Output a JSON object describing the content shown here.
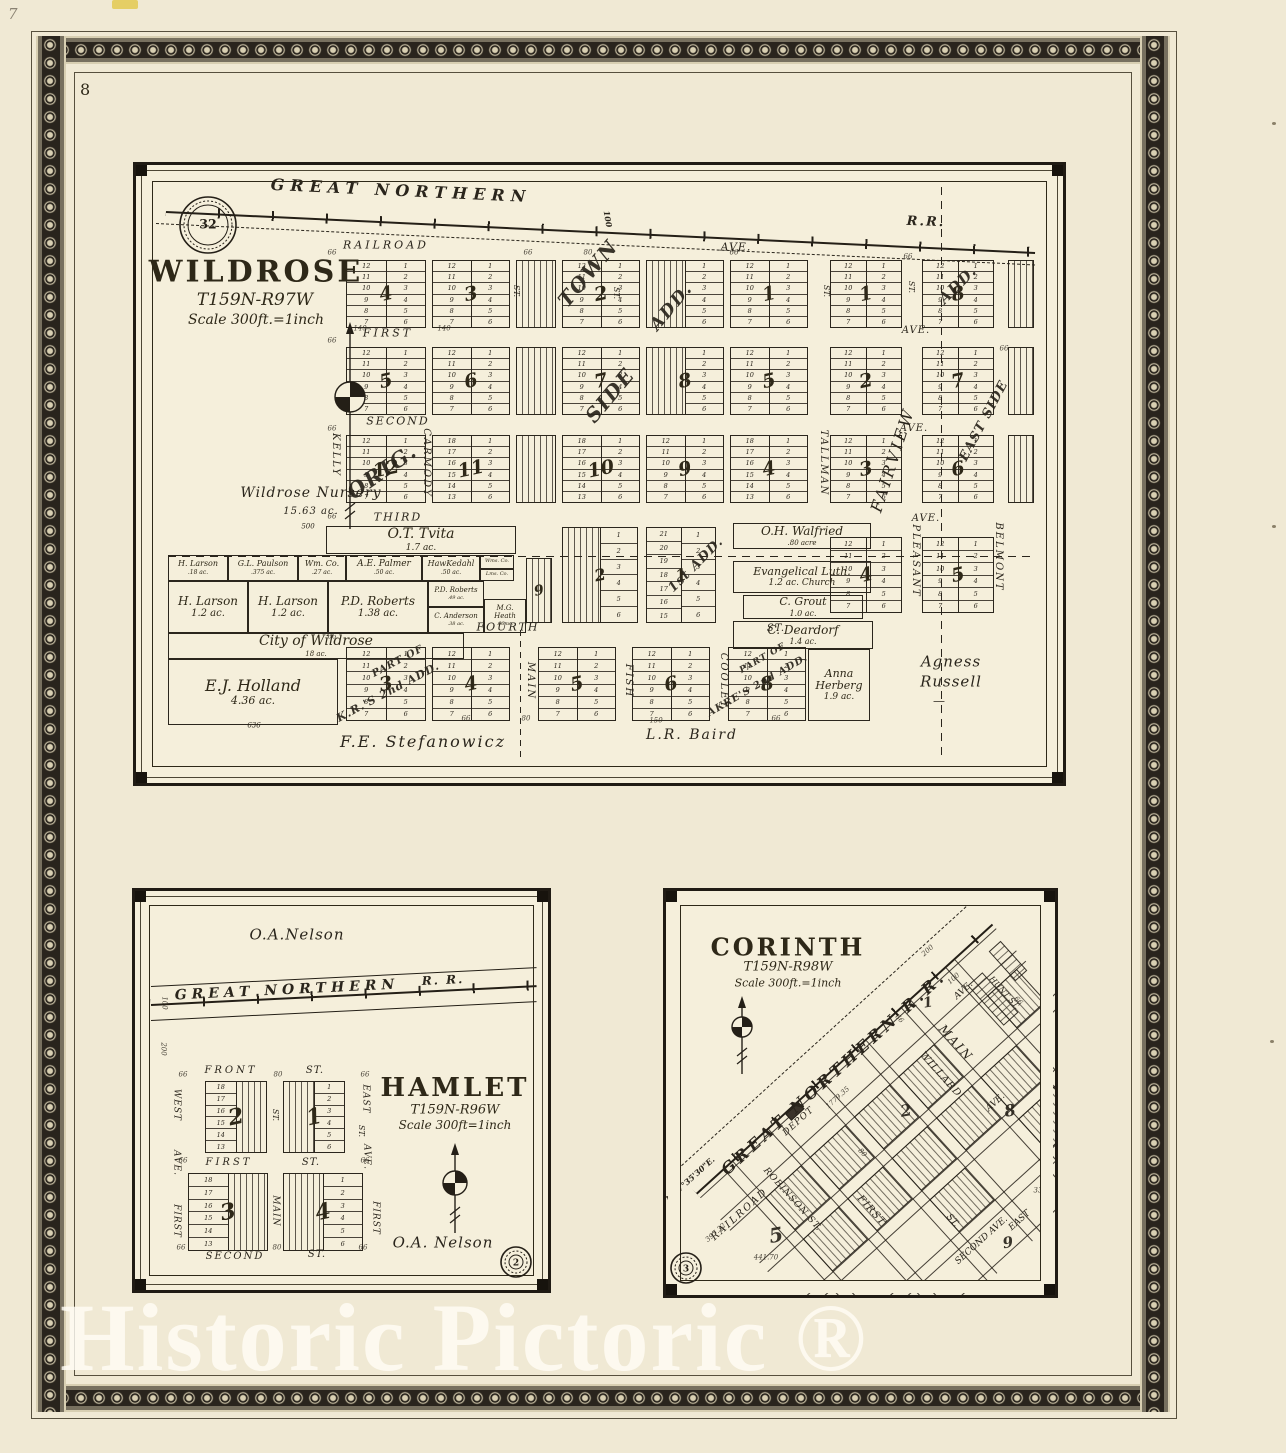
{
  "page": {
    "number": "8",
    "pencil_mark": "7",
    "watermark": "Historic Pictoric ®"
  },
  "colors": {
    "paper": "#f0e9d4",
    "panel_paper": "#f5efdb",
    "ink": "#2a251c",
    "border_band": "#29241d"
  },
  "wildrose": {
    "title": "WILDROSE",
    "township": "T159N-R97W",
    "scale": "Scale 300ft.=1inch",
    "section_stamp": "32",
    "rrlabels": [
      [
        "GREAT NORTHERN",
        265,
        26,
        2.7,
        16,
        6
      ],
      [
        "R.R.",
        790,
        57,
        2,
        13,
        2
      ],
      [
        "100",
        472,
        54,
        80,
        8,
        0
      ]
    ],
    "streets": [
      [
        "RAILROAD",
        250,
        80,
        0,
        11,
        3
      ],
      [
        "AVE.",
        600,
        82,
        0,
        11,
        1
      ],
      [
        "FIRST",
        252,
        168,
        0,
        11,
        3
      ],
      [
        "AVE.",
        780,
        166,
        0,
        10,
        1
      ],
      [
        "SECOND",
        262,
        256,
        0,
        11,
        2
      ],
      [
        "AVE.",
        778,
        264,
        0,
        10,
        1
      ],
      [
        "THIRD",
        262,
        352,
        0,
        11,
        2
      ],
      [
        "AVE.",
        790,
        354,
        0,
        10,
        1
      ],
      [
        "FOURTH",
        372,
        462,
        0,
        11,
        2
      ],
      [
        "ST.",
        640,
        464,
        0,
        10,
        1
      ],
      [
        "KELLY",
        199,
        290,
        90,
        10,
        2
      ],
      [
        "CARMODY",
        290,
        298,
        90,
        10,
        2
      ],
      [
        "MAIN",
        394,
        516,
        90,
        10,
        2
      ],
      [
        "FISH",
        492,
        516,
        90,
        10,
        2
      ],
      [
        "COOLEY",
        587,
        516,
        90,
        10,
        2
      ],
      [
        "TALLMAN",
        687,
        298,
        90,
        10,
        2
      ],
      [
        "PLEASANT",
        779,
        396,
        90,
        10,
        2
      ],
      [
        "BELMONT",
        862,
        392,
        90,
        10,
        2
      ],
      [
        "FAIRVIEW",
        757,
        295,
        -72,
        16,
        3
      ],
      [
        "ST.",
        380,
        126,
        90,
        8,
        0
      ],
      [
        "ST.",
        480,
        128,
        90,
        8,
        0
      ],
      [
        "ST.",
        690,
        126,
        90,
        8,
        0
      ],
      [
        "ST.",
        775,
        122,
        90,
        8,
        0
      ]
    ],
    "additions": [
      [
        "TOWN",
        452,
        108,
        -50,
        20,
        2
      ],
      [
        "SIDE",
        474,
        230,
        -50,
        20,
        2
      ],
      [
        "ADD.",
        536,
        142,
        -50,
        17,
        2
      ],
      [
        "ORIG.",
        246,
        306,
        -35,
        21,
        2
      ],
      [
        "EAST SIDE",
        848,
        256,
        -62,
        13,
        1
      ],
      [
        "1st ADD.",
        560,
        400,
        -45,
        13,
        1
      ],
      [
        "PART OF",
        262,
        497,
        -28,
        10,
        1
      ],
      [
        "K.R.'S 2nd ADD.",
        252,
        527,
        -28,
        11,
        1
      ],
      [
        "PART OF",
        627,
        494,
        -30,
        9,
        1
      ],
      [
        "AKRE'S 2nd ADD.",
        622,
        521,
        -30,
        10,
        1
      ],
      [
        "ADD.",
        822,
        120,
        -45,
        15,
        1
      ]
    ],
    "texts": [
      [
        "Wildrose Nursery",
        175,
        328,
        0,
        14,
        1
      ],
      [
        "15.63 ac.",
        175,
        347,
        0,
        10,
        1
      ],
      [
        "500",
        172,
        362,
        0,
        7,
        0
      ],
      [
        "F.E. Stefanowicz",
        287,
        577,
        0,
        16,
        2
      ],
      [
        "L.R. Baird",
        556,
        570,
        0,
        14,
        2
      ],
      [
        "Agness",
        815,
        497,
        0,
        15,
        1
      ],
      [
        "Russell",
        815,
        517,
        0,
        15,
        1
      ],
      [
        "—",
        803,
        536,
        0,
        12,
        0
      ],
      [
        "636",
        118,
        561,
        0,
        7,
        0
      ]
    ],
    "dims": [
      [
        "66",
        196,
        88
      ],
      [
        "66",
        392,
        88
      ],
      [
        "80",
        452,
        88
      ],
      [
        "66",
        598,
        88
      ],
      [
        "66",
        196,
        176
      ],
      [
        "66",
        196,
        264
      ],
      [
        "66",
        196,
        352
      ],
      [
        "66",
        196,
        472
      ],
      [
        "66",
        330,
        554
      ],
      [
        "80",
        390,
        554
      ],
      [
        "66",
        772,
        92
      ],
      [
        "66",
        868,
        184
      ],
      [
        "140",
        224,
        164
      ],
      [
        "140",
        308,
        164
      ],
      [
        "150",
        520,
        556
      ],
      [
        "66",
        640,
        554
      ]
    ],
    "blocks": [
      [
        210,
        95,
        80,
        68,
        "4",
        "12",
        "6"
      ],
      [
        296,
        95,
        78,
        68,
        "3",
        "12",
        "6"
      ],
      [
        380,
        95,
        40,
        68,
        "",
        "s",
        ""
      ],
      [
        426,
        95,
        78,
        68,
        "2",
        "12",
        "6"
      ],
      [
        510,
        95,
        78,
        68,
        "",
        "s",
        "6"
      ],
      [
        594,
        95,
        78,
        68,
        "1",
        "12",
        "6"
      ],
      [
        694,
        95,
        72,
        68,
        "1",
        "12",
        "6"
      ],
      [
        786,
        95,
        72,
        68,
        "8",
        "12",
        "6"
      ],
      [
        872,
        95,
        26,
        68,
        "",
        "s",
        ""
      ],
      [
        210,
        182,
        80,
        68,
        "5",
        "12",
        "6"
      ],
      [
        296,
        182,
        78,
        68,
        "6",
        "12",
        "6"
      ],
      [
        380,
        182,
        40,
        68,
        "",
        "s",
        ""
      ],
      [
        426,
        182,
        78,
        68,
        "7",
        "12",
        "6"
      ],
      [
        510,
        182,
        78,
        68,
        "8",
        "s",
        "6"
      ],
      [
        594,
        182,
        78,
        68,
        "5",
        "12",
        "6"
      ],
      [
        694,
        182,
        72,
        68,
        "2",
        "12",
        "6"
      ],
      [
        786,
        182,
        72,
        68,
        "7",
        "12",
        "6"
      ],
      [
        872,
        182,
        26,
        68,
        "",
        "s",
        ""
      ],
      [
        210,
        270,
        80,
        68,
        "12",
        "12",
        "6"
      ],
      [
        296,
        270,
        78,
        68,
        "11",
        "18",
        "6"
      ],
      [
        380,
        270,
        40,
        68,
        "",
        "s",
        ""
      ],
      [
        426,
        270,
        78,
        68,
        "10",
        "18",
        "6"
      ],
      [
        510,
        270,
        78,
        68,
        "9",
        "12",
        "6"
      ],
      [
        594,
        270,
        78,
        68,
        "4",
        "18",
        "6"
      ],
      [
        694,
        270,
        72,
        68,
        "3",
        "12",
        "6"
      ],
      [
        786,
        270,
        72,
        68,
        "6",
        "12",
        "6"
      ],
      [
        872,
        270,
        26,
        68,
        "",
        "s",
        ""
      ],
      [
        390,
        393,
        26,
        65,
        "9",
        "s",
        "",
        14
      ],
      [
        426,
        362,
        76,
        96,
        "2",
        "s",
        "6",
        16
      ],
      [
        510,
        362,
        70,
        96,
        "1",
        "21",
        "6",
        16
      ],
      [
        694,
        372,
        72,
        76,
        "4",
        "12",
        "6"
      ],
      [
        786,
        372,
        72,
        76,
        "5",
        "12",
        "6"
      ],
      [
        210,
        482,
        80,
        74,
        "3",
        "12",
        "6"
      ],
      [
        296,
        482,
        78,
        74,
        "4",
        "12",
        "6"
      ],
      [
        402,
        482,
        78,
        74,
        "5",
        "12",
        "6"
      ],
      [
        496,
        482,
        78,
        74,
        "6",
        "12",
        "6"
      ],
      [
        592,
        482,
        78,
        74,
        "8",
        "12",
        "6"
      ]
    ],
    "parcels": [
      [
        190,
        361,
        190,
        28,
        "O.T. Tvita",
        "1.7 ac.",
        14,
        9
      ],
      [
        32,
        390,
        60,
        26,
        "H. Larson",
        ".18 ac.",
        8,
        6
      ],
      [
        92,
        390,
        70,
        26,
        "G.L. Paulson",
        ".375 ac.",
        8,
        6
      ],
      [
        162,
        390,
        48,
        26,
        "Wm. Co.",
        ".27 ac.",
        8,
        6
      ],
      [
        210,
        390,
        76,
        26,
        "A.E. Palmer",
        ".50 ac.",
        9,
        6
      ],
      [
        286,
        390,
        58,
        26,
        "HawKedahl",
        ".50 ac.",
        8,
        6
      ],
      [
        344,
        390,
        34,
        14,
        "Wms. Co.",
        "",
        5,
        5
      ],
      [
        344,
        404,
        34,
        12,
        "Lms. Co.",
        "",
        5,
        5
      ],
      [
        32,
        416,
        80,
        52,
        "H. Larson",
        "1.2 ac.",
        12,
        10
      ],
      [
        112,
        416,
        80,
        52,
        "H. Larson",
        "1.2 ac.",
        12,
        10
      ],
      [
        192,
        416,
        100,
        52,
        "P.D. Roberts",
        "1.38 ac.",
        12,
        10
      ],
      [
        292,
        416,
        56,
        26,
        "P.D. Roberts",
        ".49 ac.",
        7,
        5
      ],
      [
        292,
        442,
        56,
        26,
        "C. Anderson",
        ".38 ac.",
        7,
        5
      ],
      [
        348,
        434,
        42,
        34,
        "M.G. Heath",
        ".66 ac.",
        7,
        5
      ],
      [
        32,
        468,
        296,
        26,
        "City of Wildrose",
        "18 ac.",
        14,
        7
      ],
      [
        32,
        494,
        170,
        66,
        "E.J. Holland",
        "4.36 ac.",
        16,
        11
      ],
      [
        597,
        358,
        138,
        26,
        "O.H. Walfried",
        ".80 acre",
        12,
        7
      ],
      [
        597,
        396,
        138,
        32,
        "Evangelical Luth.",
        "1.2 ac. Church",
        11,
        9
      ],
      [
        607,
        430,
        120,
        24,
        "C. Grout",
        "1.0 ac.",
        11,
        8
      ],
      [
        597,
        456,
        140,
        28,
        "C. Deardorf",
        "1.4 ac.",
        12,
        8
      ],
      [
        672,
        484,
        62,
        72,
        "Anna Herberg",
        "1.9 ac.",
        11,
        9
      ]
    ]
  },
  "hamlet": {
    "title": "HAMLET",
    "township": "T159N-R96W",
    "scale": "Scale 300ft=1inch",
    "section_stamp": "2",
    "rrlabels": [
      [
        "GREAT NORTHERN",
        152,
        99,
        -2.8,
        14,
        5
      ],
      [
        "R. R.",
        308,
        89,
        -2.8,
        12,
        2
      ]
    ],
    "streets": [
      [
        "FRONT",
        96,
        180,
        0,
        10,
        3
      ],
      [
        "ST.",
        180,
        180,
        0,
        10,
        1
      ],
      [
        "FIRST",
        94,
        272,
        0,
        10,
        3
      ],
      [
        "ST.",
        176,
        272,
        0,
        10,
        1
      ],
      [
        "SECOND",
        100,
        366,
        0,
        10,
        2
      ],
      [
        "ST.",
        182,
        364,
        0,
        10,
        1
      ],
      [
        "WEST",
        41,
        214,
        90,
        9,
        1
      ],
      [
        "AVE.",
        41,
        272,
        90,
        9,
        1
      ],
      [
        "FIRST",
        41,
        330,
        90,
        9,
        1
      ],
      [
        "ST.",
        140,
        224,
        90,
        8,
        0
      ],
      [
        "MAIN",
        140,
        320,
        90,
        9,
        1
      ],
      [
        "EAST",
        230,
        208,
        90,
        9,
        1
      ],
      [
        "AVE.",
        231,
        266,
        90,
        9,
        1
      ],
      [
        "FIRST",
        240,
        327,
        90,
        9,
        1
      ],
      [
        "ST.",
        226,
        240,
        90,
        8,
        0
      ]
    ],
    "texts": [
      [
        "O.A.Nelson",
        162,
        44,
        0,
        15,
        1
      ],
      [
        "O.A. Nelson",
        308,
        352,
        0,
        15,
        1
      ]
    ],
    "dims": [
      [
        "100",
        29,
        112,
        90
      ],
      [
        "200",
        28,
        158,
        90
      ],
      [
        "66",
        48,
        184
      ],
      [
        "80",
        143,
        184
      ],
      [
        "66",
        230,
        184
      ],
      [
        "66",
        46,
        357
      ],
      [
        "80",
        142,
        357
      ],
      [
        "66",
        228,
        357
      ],
      [
        "66",
        48,
        270
      ],
      [
        "66",
        230,
        270
      ]
    ],
    "blocks": [
      [
        70,
        190,
        62,
        72,
        "2",
        "18",
        "s"
      ],
      [
        148,
        190,
        62,
        72,
        "1",
        "s",
        "6"
      ],
      [
        53,
        282,
        80,
        78,
        "3",
        "18",
        "s"
      ],
      [
        148,
        282,
        80,
        78,
        "4",
        "s",
        "6"
      ]
    ]
  },
  "corinth": {
    "title": "CORINTH",
    "township": "T159N-R98W",
    "scale": "Scale 300ft.=1inch",
    "section_stamp": "3",
    "labels": [
      [
        "GREAT NORTHERN R.R.",
        168,
        182,
        -42,
        16,
        4
      ],
      [
        "N.47°35'30\"E.",
        24,
        288,
        -42,
        8,
        0
      ],
      [
        "RAILROAD",
        74,
        324,
        -42,
        10,
        2
      ],
      [
        "ROBINSON ST.",
        126,
        309,
        48,
        9,
        1
      ],
      [
        "MAIN",
        290,
        152,
        48,
        12,
        2
      ],
      [
        "WILLARD",
        274,
        184,
        48,
        10,
        1
      ],
      [
        "FIRST",
        205,
        320,
        48,
        10,
        1
      ],
      [
        "ST.",
        286,
        330,
        48,
        9,
        0
      ],
      [
        "HUNT ST.",
        338,
        102,
        48,
        8,
        0
      ],
      [
        "AVE.",
        298,
        100,
        -42,
        9,
        0
      ],
      [
        "AVE.",
        330,
        212,
        -42,
        9,
        0
      ],
      [
        "SECOND AVE.",
        316,
        350,
        -42,
        9,
        0
      ],
      [
        "EAST",
        354,
        330,
        -42,
        9,
        0
      ],
      [
        "DEPOT",
        133,
        231,
        -42,
        9,
        1
      ]
    ],
    "dims": [
      [
        "200",
        262,
        60,
        -42
      ],
      [
        "100",
        288,
        88,
        -42
      ],
      [
        "1779.35",
        172,
        207,
        -42
      ],
      [
        "441.70",
        100,
        367,
        0
      ],
      [
        "397.32",
        50,
        342,
        -42
      ],
      [
        "66",
        233,
        128,
        48
      ],
      [
        "80",
        196,
        262,
        48
      ],
      [
        "33",
        372,
        300,
        0
      ],
      [
        "66",
        352,
        110,
        48
      ]
    ],
    "block_numbers": [
      [
        "1",
        262,
        112,
        14
      ],
      [
        "2",
        240,
        220,
        16
      ],
      [
        "5",
        110,
        344,
        20
      ],
      [
        "8",
        344,
        220,
        16
      ],
      [
        "9",
        342,
        352,
        15
      ]
    ],
    "grid": {
      "u_lines": [
        36,
        48,
        96,
        108,
        156,
        168,
        216,
        228,
        276,
        288,
        336,
        348
      ],
      "v_lines": [
        34,
        48,
        92,
        104,
        148,
        160,
        204,
        216,
        252
      ],
      "hatches": [
        [
          48,
          48,
          48,
          44
        ],
        [
          108,
          48,
          48,
          44
        ],
        [
          168,
          48,
          48,
          44
        ],
        [
          228,
          48,
          48,
          44
        ],
        [
          108,
          104,
          48,
          44
        ],
        [
          168,
          104,
          48,
          44
        ],
        [
          228,
          104,
          48,
          44
        ],
        [
          288,
          104,
          48,
          44
        ],
        [
          168,
          160,
          48,
          44
        ],
        [
          288,
          160,
          48,
          44
        ],
        [
          348,
          48,
          40,
          44
        ],
        [
          48,
          104,
          48,
          44
        ]
      ]
    }
  }
}
